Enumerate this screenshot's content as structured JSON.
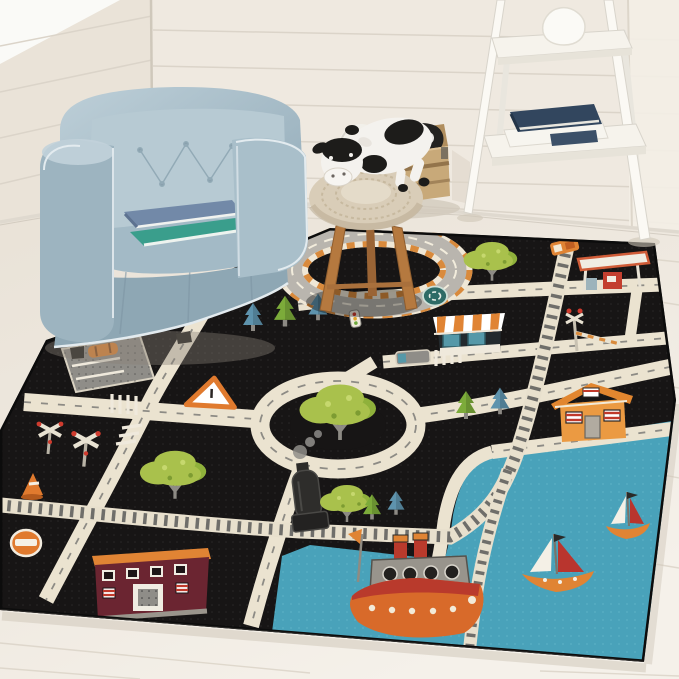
{
  "meta": {
    "kind": "product-photo",
    "subject": "Black kids' city road play rug styled in a white living-room corner",
    "visible_text": "none"
  },
  "room": {
    "wall": "white shiplap planks, corner seam at left, vertical seam at right",
    "floor": "pale wood planks",
    "furniture": [
      {
        "name": "tufted tub armchair",
        "color_note": "dusty light blue with white piping",
        "items_on_seat": [
          "blue-gray book",
          "teal book"
        ]
      },
      {
        "name": "wooden toy crate",
        "contents": [
          "soccer ball",
          "black-and-white plush"
        ]
      },
      {
        "name": "white ladder shelf",
        "items": [
          "white vase",
          "navy book",
          "white book",
          "small navy book"
        ]
      },
      {
        "name": "round wooden stool with crocheted pouf top",
        "items": [
          "plush cow toy"
        ]
      }
    ]
  },
  "rug": {
    "style": "black children's road-play rug with ivory roads and harbor",
    "motifs": [
      "racetrack loop with orange striped curbs",
      "roundabout with large green tree island",
      "train track with orange engine",
      "gas station with red pump",
      "railroad crossing gate and crossbuck signs",
      "striped-awning shop",
      "orange gable house",
      "maroon school building with orange roof band",
      "gray parking lot with orange car",
      "black steam locomotive with smoke",
      "gray bus and crosswalks",
      "traffic cone, no-entry sign, warning triangle, roundabout sign, traffic light",
      "green and blue pine trees, broccoli-style leafy trees",
      "blue harbor water with two sailboats and an orange steamboat"
    ],
    "counts": {
      "sailboats": 2,
      "steamboats": 1,
      "big_trees": 4,
      "pine_trees": 7,
      "buildings": 4
    }
  },
  "colors": {
    "wall": "#efe9e0",
    "wall_left": "#eae3d8",
    "wall_bright": "#fafaf7",
    "seam": "#dbd4c9",
    "floor": "#ede7dd",
    "floor_bright": "#f6f2ec",
    "plank": "#d9d2c5",
    "shadow": "#cfc6b8",
    "rug": "#171515",
    "road": "#ebe3d0",
    "road_gray": "#b9b5ae",
    "dash": "#8d8b85",
    "curb_orange": "#d98a3c",
    "track_band": "#e8e0cd",
    "track_tie": "#6f6e6a",
    "water": "#49a2ba",
    "water_light": "#66b4c8",
    "tree": "#a9c14c",
    "tree_dark": "#8fb13b",
    "pine_green": "#7cab3a",
    "pine_blue": "#5e93ad",
    "trunk": "#8d8a84",
    "orange": "#e08434",
    "red_orange": "#c33f2f",
    "maroon": "#6b2531",
    "red": "#b9352e",
    "house": "#eb9a42",
    "gray_deck": "#98948c",
    "hull_orange": "#d86a2a",
    "hull_red": "#b93a2c",
    "chair": "#a9bfca",
    "chair_light": "#bccdd6",
    "chair_dark": "#8ea7b4",
    "piping": "#e3ebef",
    "wood": "#c8a979",
    "wood_dark": "#8a6b44",
    "stool_wood": "#b5793f",
    "pouf": "#d9cdb8",
    "cow_white": "#f4f2ee",
    "cow_black": "#1d1c1a",
    "book_navy": "#32465e",
    "book_teal": "#3a9e8c",
    "book_blue": "#7289a8",
    "white": "#f6f3ec"
  }
}
